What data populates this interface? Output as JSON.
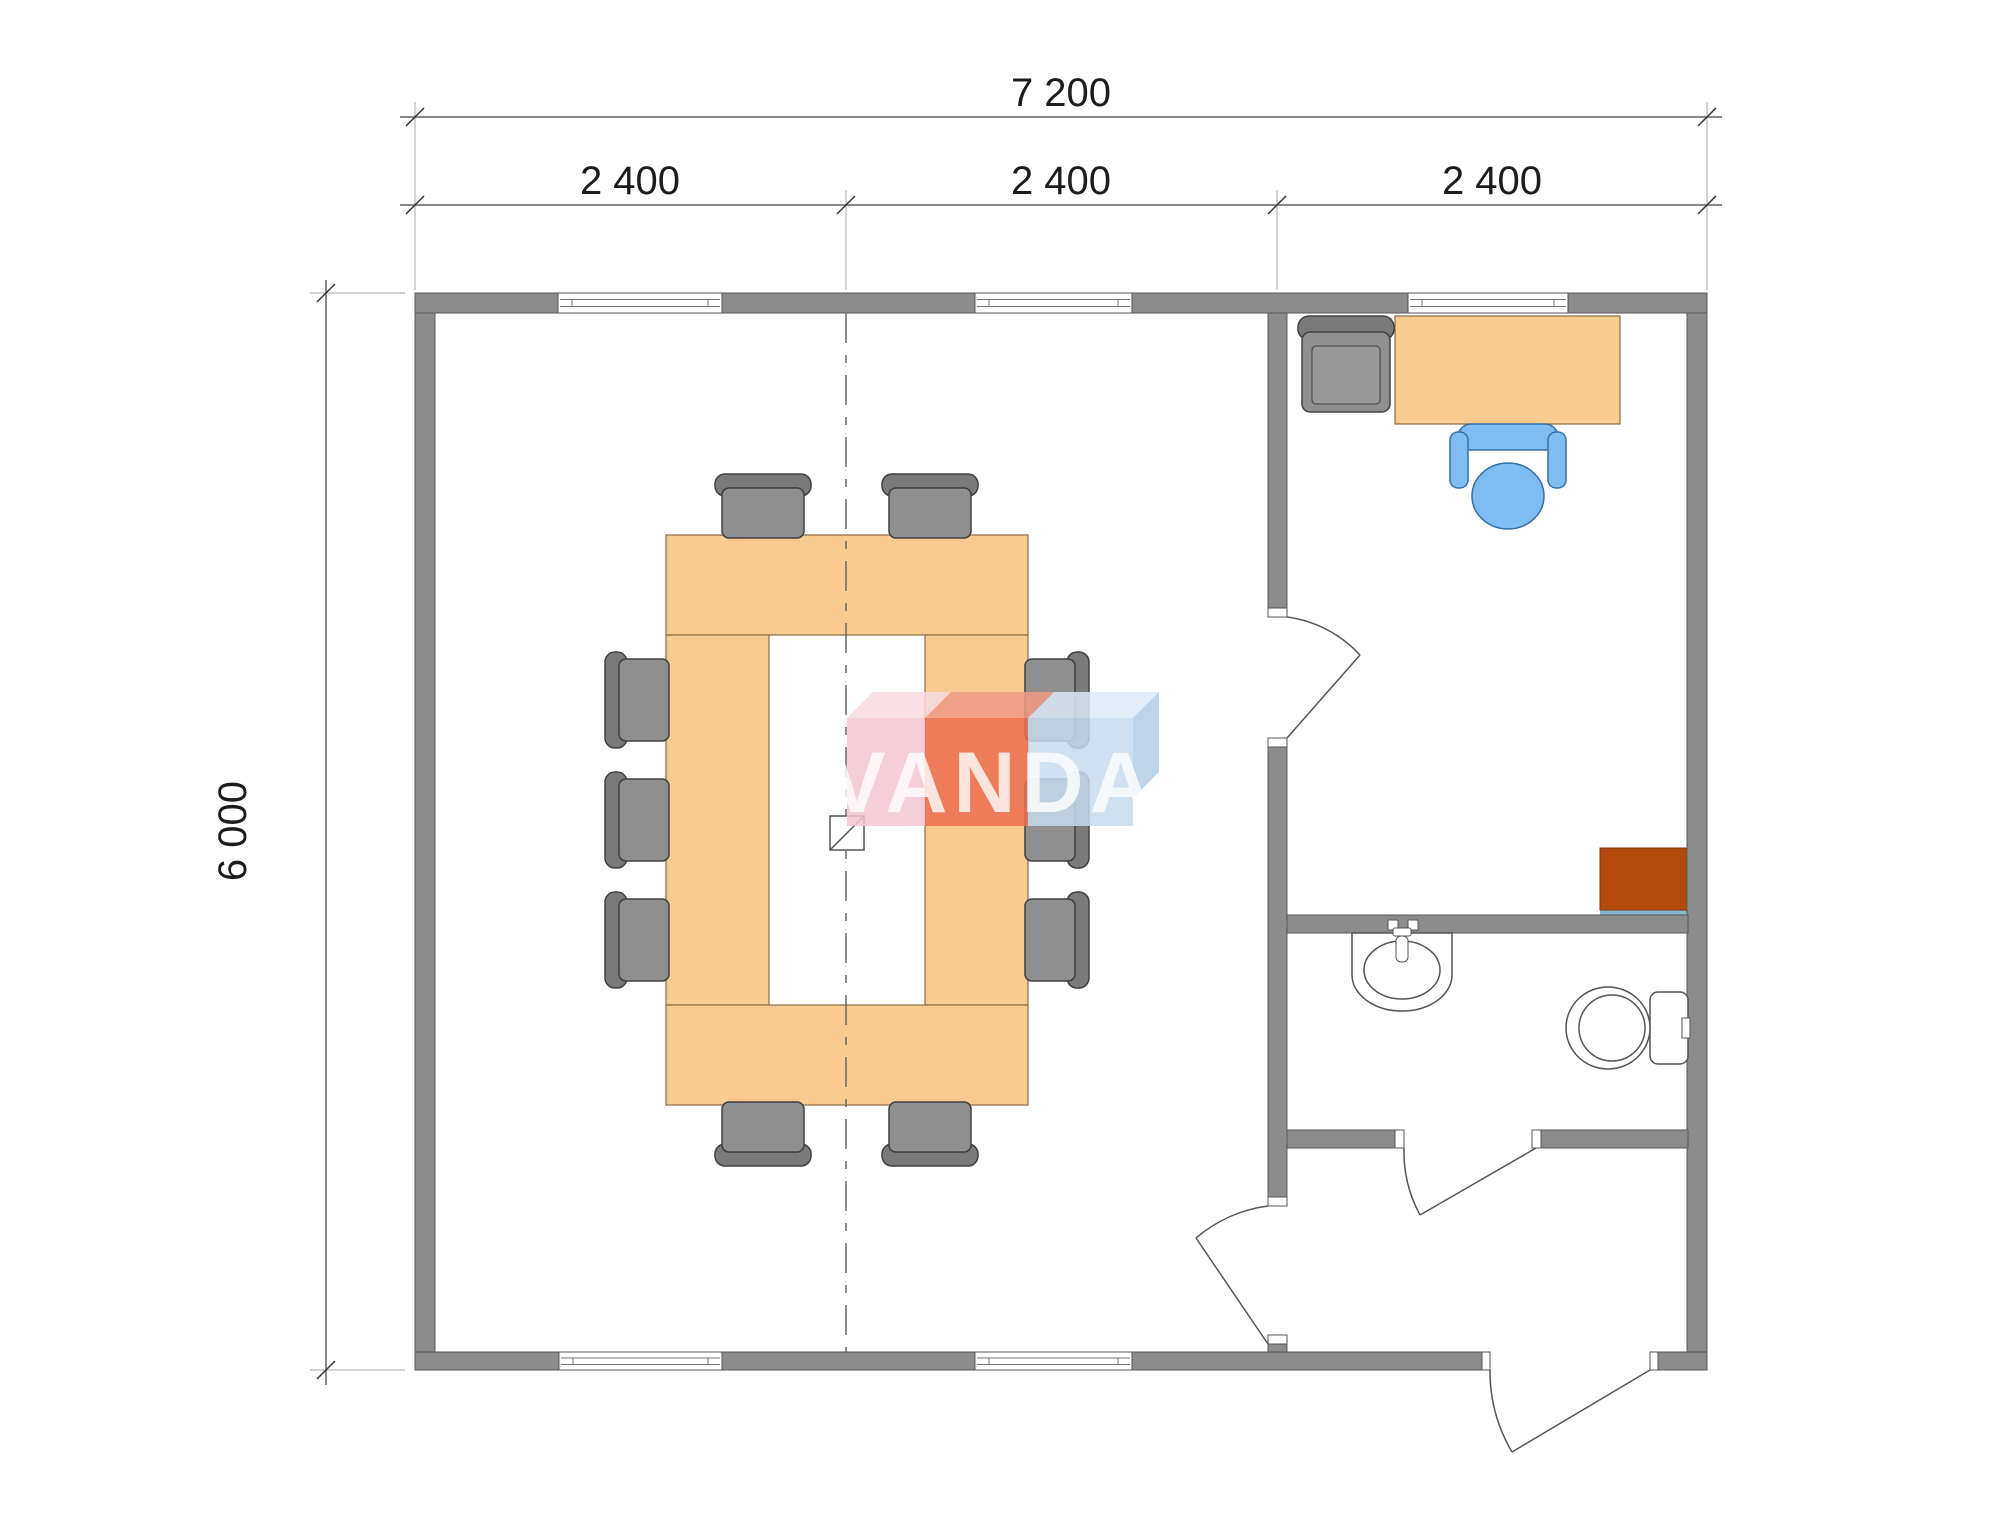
{
  "page": {
    "type": "architectural-floor-plan"
  },
  "dimensions": {
    "total_width_label": "7 200",
    "bay_labels": [
      "2 400",
      "2 400",
      "2 400"
    ],
    "height_label": "6 000"
  },
  "watermark": {
    "text": "VANDA"
  },
  "colors": {
    "wall": "#8c8c8c",
    "wall_outline": "#585858",
    "window_fill": "#ffffff",
    "table": "#f9cb90",
    "table_outline": "#8a6b42",
    "chair": "#8f8f8f",
    "chair_outline": "#404040",
    "office_chair_blue": "#7fbdf0",
    "office_chair_blue_outline": "#396fa8",
    "cabinet_brown": "#b24a0e",
    "cabinet_shadow_teal": "#86b7cc",
    "fixture_outline": "#555555",
    "centerline": "#666666",
    "dimension_line": "#8a8a8a",
    "dimension_text": "#1c1c1c",
    "watermark_pink": "#f4c6d0",
    "watermark_red": "#ec6e52",
    "watermark_blue": "#c8dbec",
    "watermark_pink_top": "#f8dbe1",
    "watermark_red_top": "#f09b85",
    "watermark_blue_top": "#dde9f5",
    "watermark_side_blue": "#b3cde4",
    "watermark_letters": "#ffffff"
  },
  "rooms": [
    {
      "name": "meeting-room"
    },
    {
      "name": "office"
    },
    {
      "name": "bathroom"
    },
    {
      "name": "entrance-hall"
    }
  ],
  "furniture": {
    "meeting_table_seats": 10,
    "items": [
      "u-shaped-conference-table",
      "conference-chair",
      "office-desk",
      "blue-desk-chair",
      "office-armchair",
      "brown-cabinet",
      "wash-basin",
      "toilet",
      "column-symbol"
    ]
  }
}
